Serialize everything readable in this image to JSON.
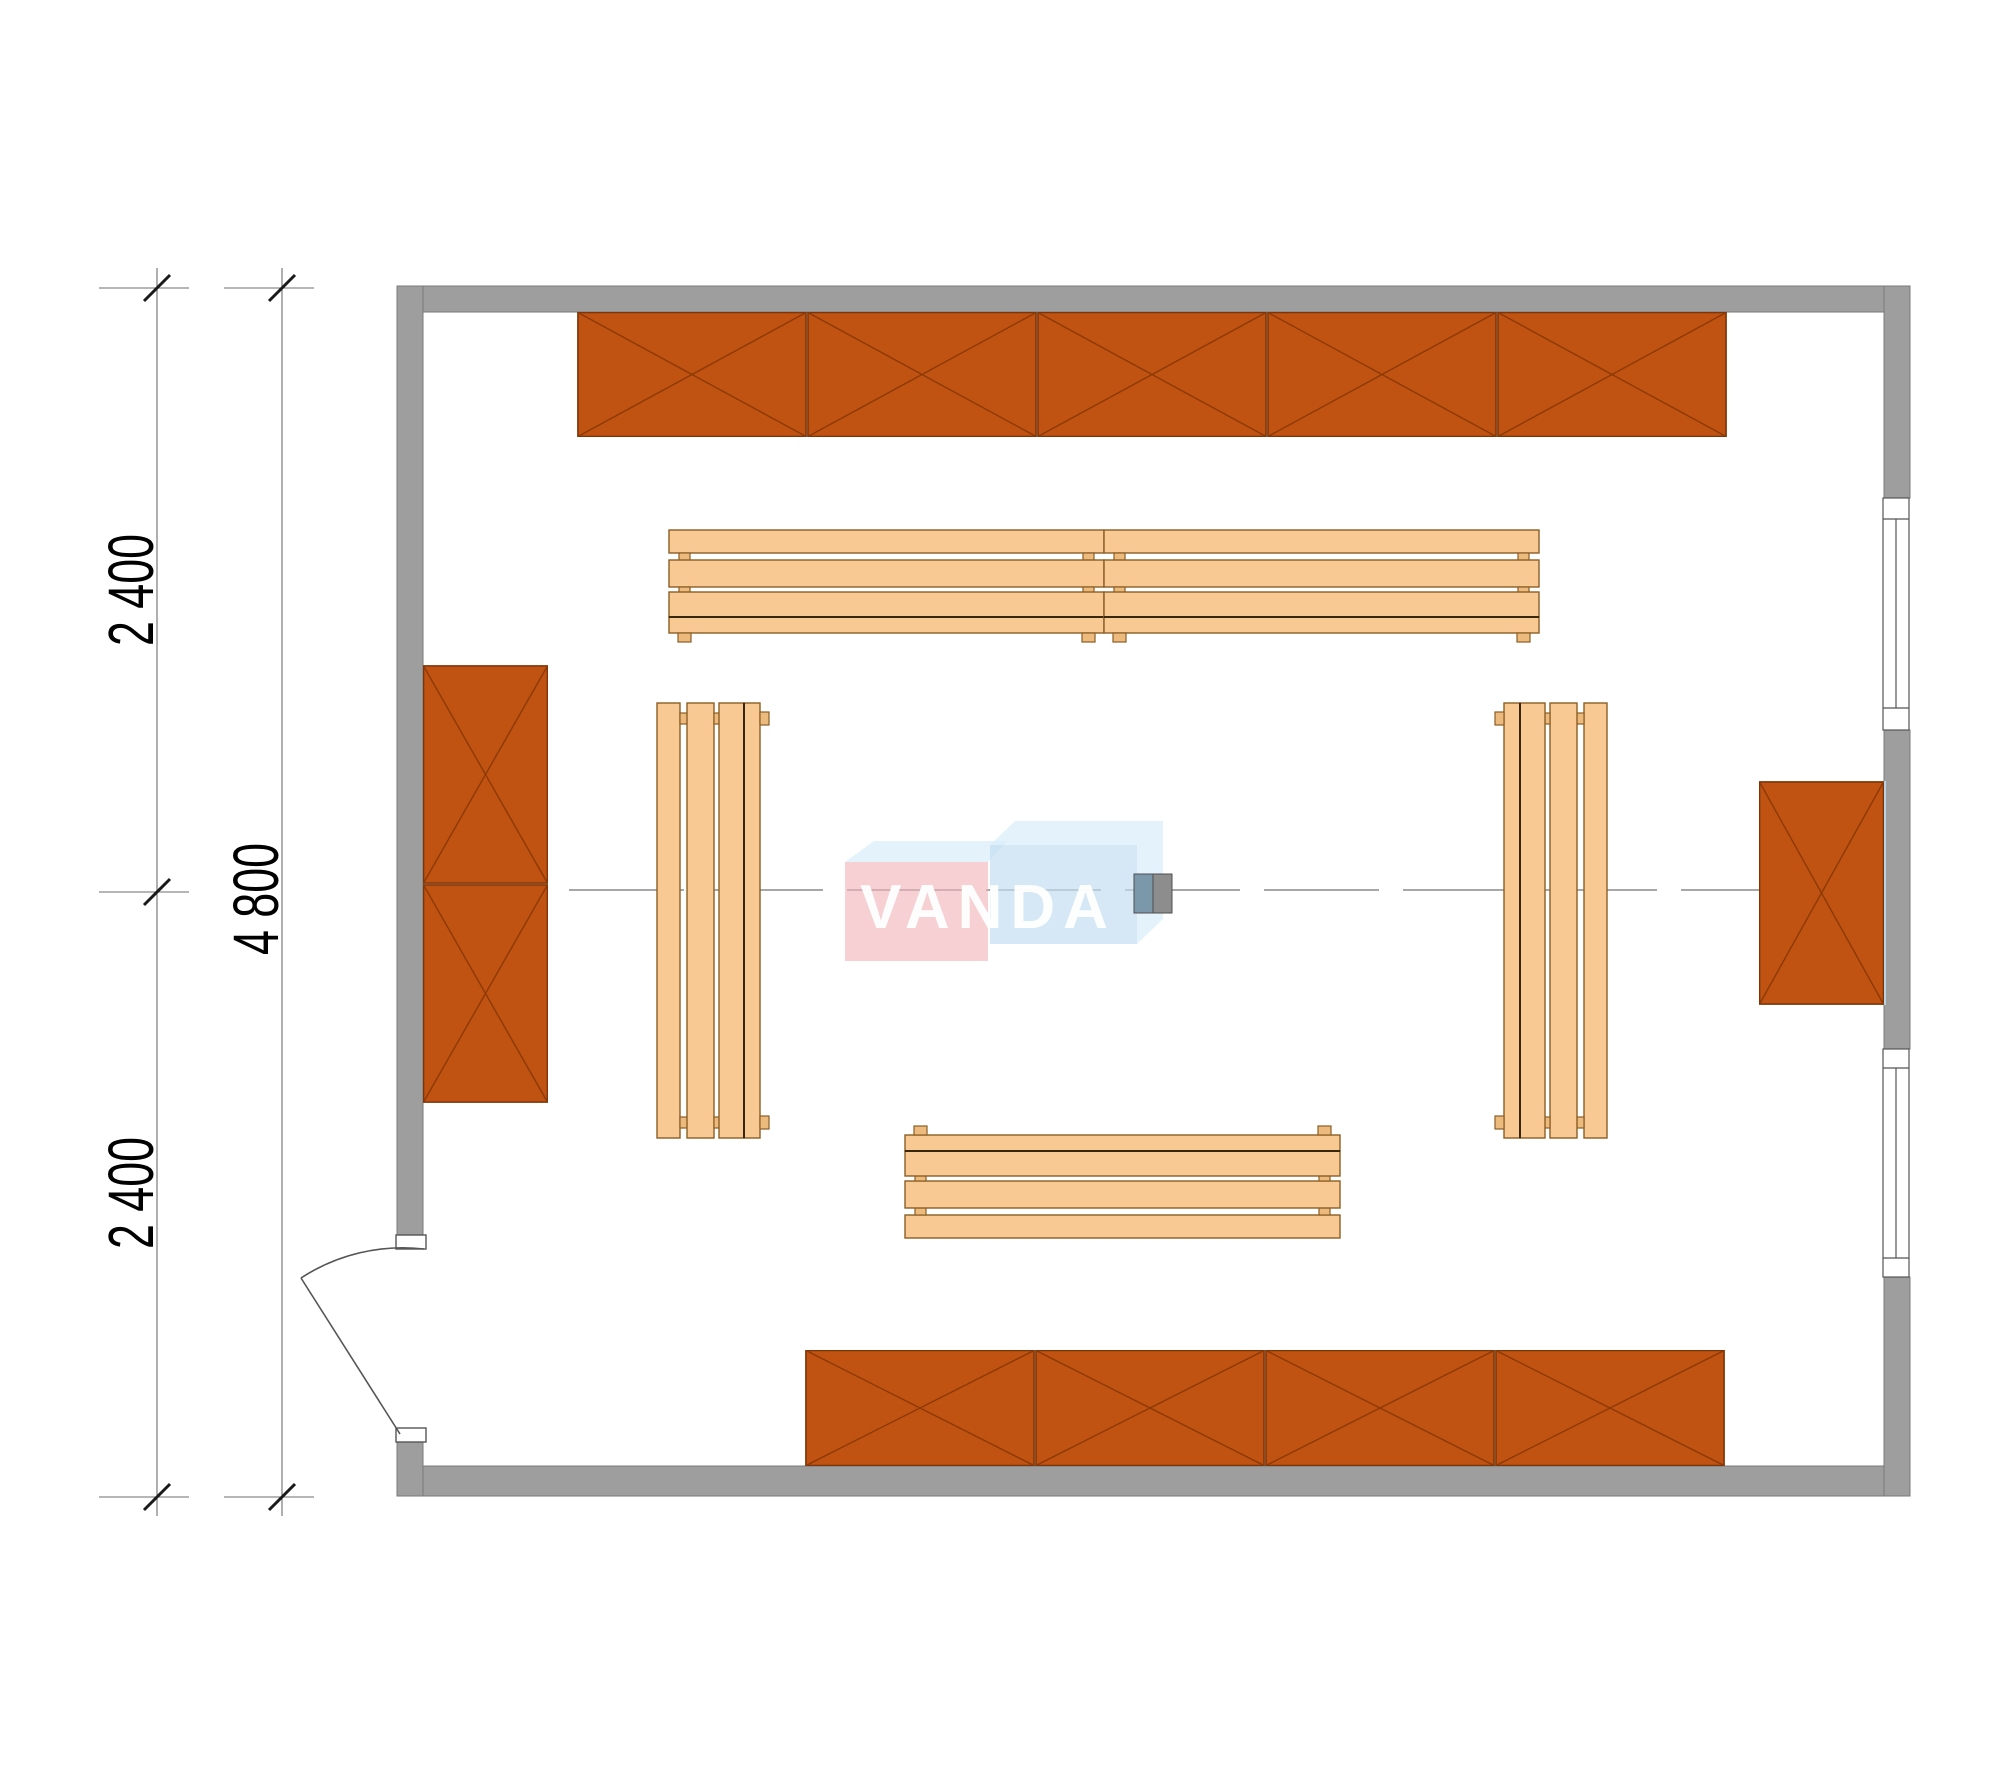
{
  "drawing": {
    "kind": "room floor plan with furniture",
    "watermark": {
      "text": "VANDA"
    },
    "dimensions": {
      "segment_top": "2 400",
      "total": "4 800",
      "segment_bottom": "2 400"
    }
  },
  "colors": {
    "wall_fill": "#9e9e9e",
    "wall_stroke": "#7a7a7a",
    "cabinet_fill": "#c05212",
    "cabinet_stroke": "#7d3406",
    "cabinet_x": "#8c3a06",
    "bench_fill": "#f9c994",
    "bench_stroke": "#8a5e24",
    "bench_line": "#3a280e",
    "foot_fill": "#edba7e",
    "dim": "#6e6e6e",
    "tick": "#1a1a1a",
    "text": "#000000",
    "centerline": "#8a8a8a",
    "door": "#555555",
    "line_dark": "#555555",
    "wm_pink": "#f0b3b8",
    "wm_blue": "#c3ddf0",
    "wm_flap": "#d9edfa",
    "column_blue": "#7b98ab",
    "column_gray": "#8d8d8d",
    "glass_edge": "#b8d4e4"
  }
}
